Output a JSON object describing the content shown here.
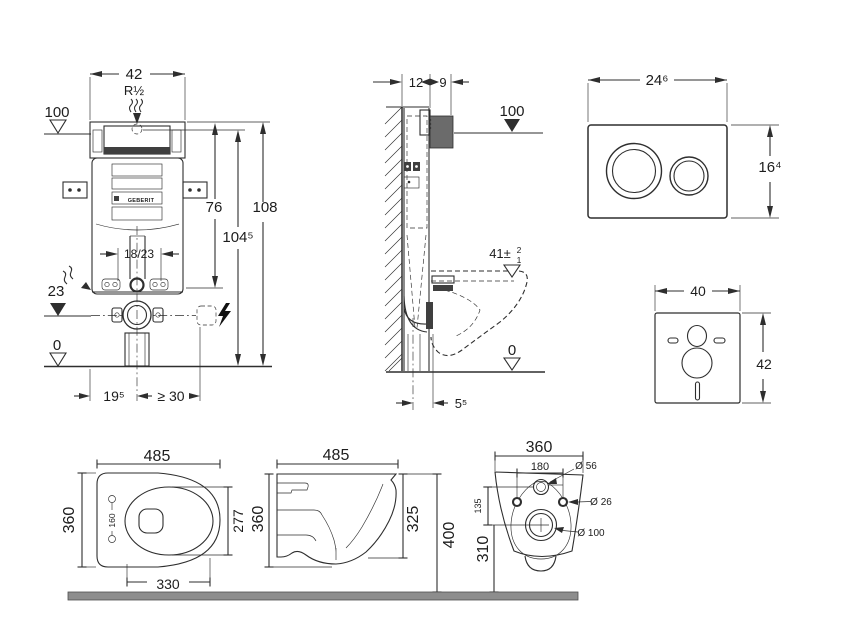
{
  "front_view": {
    "frame_width": "42",
    "water_thread": "R½",
    "supply_height": "100",
    "upper_height": "76",
    "actuation_height": "104⁵",
    "total_height": "108",
    "bolt_spacing": "18/23",
    "outlet_height": "23",
    "floor_level": "0",
    "outlet_offset_left": "19⁵",
    "clearance_right": "≥ 30",
    "brand_label": "GEBERIT"
  },
  "side_view": {
    "frame_depth": "12",
    "box_depth": "9",
    "supply_height": "100",
    "rim_height": "41±",
    "rim_tolerance_plus": "2",
    "rim_tolerance_minus": "1",
    "floor_level": "0",
    "outlet_depth": "5⁵"
  },
  "flush_plate": {
    "width": "24⁶",
    "height": "16⁴"
  },
  "insulation_mat": {
    "width": "40",
    "height": "42"
  },
  "wc_top_view": {
    "depth": "485",
    "width": "360",
    "hinge_spacing": "160",
    "bowl_width": "277",
    "bowl_depth": "330"
  },
  "wc_side_view": {
    "depth": "485",
    "body_height": "360",
    "front_edge_height": "325",
    "height_above_floor": "400"
  },
  "wc_rear_view": {
    "width": "360",
    "fixing_spacing": "180",
    "hinge_hole_dia": "Ø 56",
    "fixing_hole_dia": "Ø 26",
    "hole_offset": "135",
    "outlet_dia": "Ø 100",
    "outlet_center_height": "310"
  },
  "colors": {
    "line": "#2e2e2e",
    "dark_fill": "#3f3f3f",
    "inspection_box": "#6b6b6b",
    "floor_bar": "#8d8d8d"
  }
}
